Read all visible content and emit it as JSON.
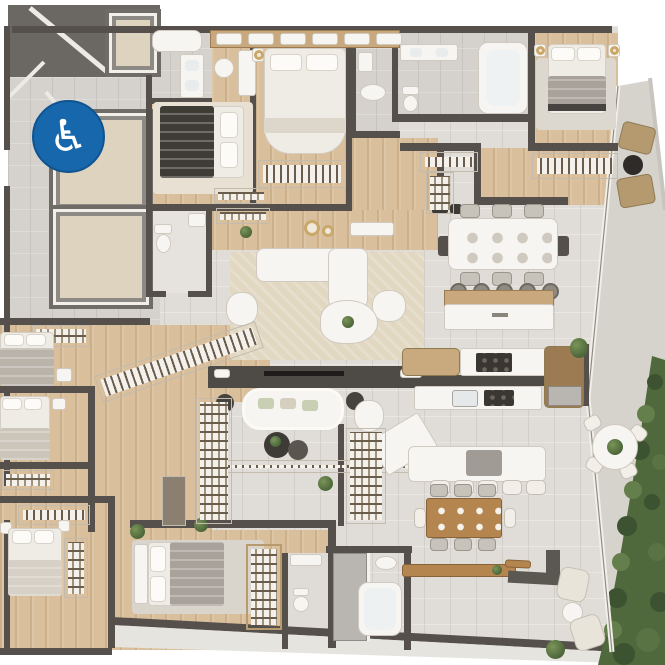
{
  "meta": {
    "title": "apartment-floor-plan-render",
    "view": "top-down-3d-render",
    "canvas": {
      "width": 665,
      "height": 665
    }
  },
  "badge": {
    "glyph": "♿",
    "meaning": "wheelchair-accessible-unit",
    "bg_color": "#1667ab",
    "fg_color": "#ffffff"
  },
  "palette": {
    "background": "#ffffff",
    "wall": "#55504b",
    "stair_zone": "#6b6763",
    "tile_floor": "#e0ddd8",
    "service_tile": "#d5d2cd",
    "wood_floor": "#d9bf9b",
    "closet_wood": "#c8a87c",
    "balcony_floor": "#d6d3cd",
    "terrace_strip": "#e6e4df",
    "elevator_cab": "#ddd3bf",
    "furniture_white": "#f7f5f1",
    "bed_gray": "#a8a29a",
    "duvet_dark": "#3f3b35",
    "rug": "#e2d8c2",
    "wood_table": "#b5854f",
    "outdoor_tan": "#b49a6e",
    "greenery": "#4f683c",
    "glass": "#f2efe9",
    "accent_gold": "#c9a86a"
  },
  "rooms": [
    "stairwell",
    "elevator-core",
    "ensuite-bath-1",
    "bedroom-1",
    "bedroom-2",
    "powder-room",
    "hallway",
    "living-room",
    "tv-lounge",
    "dining-area",
    "kitchen",
    "island-bar",
    "family-dining",
    "bathroom-small",
    "bathroom-large",
    "bedroom-3",
    "walk-in-closet",
    "dressing-corridor",
    "bedroom-4",
    "bedroom-5",
    "bedroom-6",
    "bedroom-7",
    "ensuite-bath-2",
    "bathroom-3",
    "balcony-terrace",
    "garden-border",
    "service-terrace"
  ],
  "visible_inventory": {
    "beds": 7,
    "bathrooms": 6,
    "elevators": 3,
    "dining_table_seats": 8,
    "family_table_seats": 8,
    "island_stools": 5,
    "breakfast_bar_stools": 5,
    "balcony_lounge_chairs": 4,
    "balcony_round_table_chairs": 4,
    "sofas": 2,
    "armchairs": 4
  }
}
